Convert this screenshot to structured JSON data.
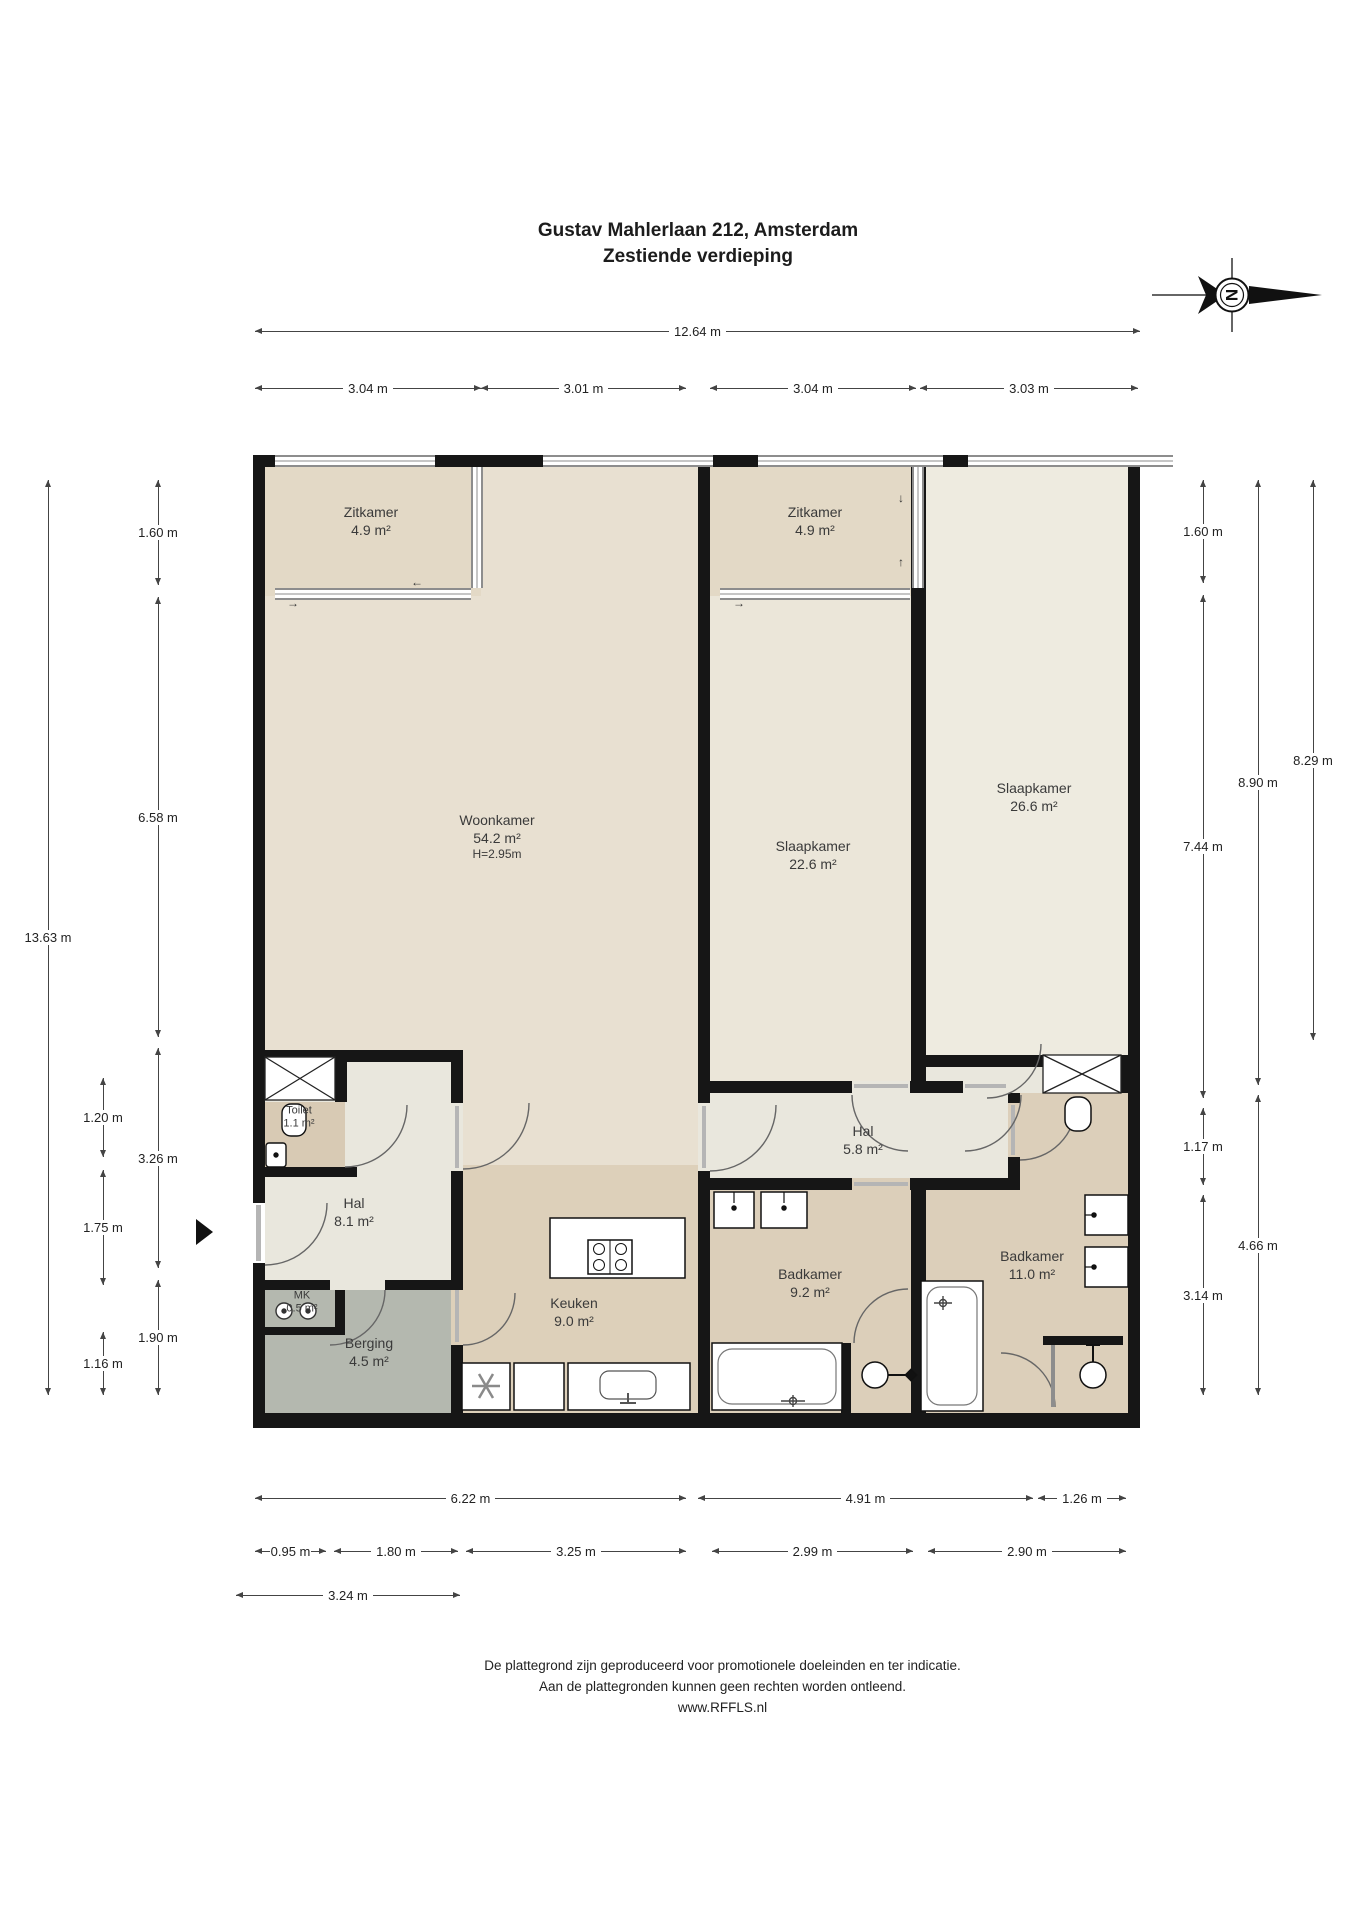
{
  "title": {
    "line1": "Gustav Mahlerlaan 212, Amsterdam",
    "line2": "Zestiende verdieping"
  },
  "compass": {
    "letter": "N"
  },
  "rooms": {
    "zitkamer_left": {
      "name": "Zitkamer",
      "area": "4.9 m²"
    },
    "zitkamer_right": {
      "name": "Zitkamer",
      "area": "4.9 m²"
    },
    "woonkamer": {
      "name": "Woonkamer",
      "area": "54.2 m²",
      "height": "H=2.95m"
    },
    "slaapkamer_1": {
      "name": "Slaapkamer",
      "area": "22.6 m²"
    },
    "slaapkamer_2": {
      "name": "Slaapkamer",
      "area": "26.6 m²"
    },
    "toilet": {
      "name": "Toilet",
      "area": "1.1 m²"
    },
    "hal": {
      "name": "Hal",
      "area": "8.1 m²"
    },
    "mk": {
      "name": "MK",
      "area": "0.5 m²"
    },
    "berging": {
      "name": "Berging",
      "area": "4.5 m²"
    },
    "keuken": {
      "name": "Keuken",
      "area": "9.0 m²"
    },
    "hal2": {
      "name": "Hal",
      "area": "5.8 m²"
    },
    "badkamer_1": {
      "name": "Badkamer",
      "area": "9.2 m²"
    },
    "badkamer_2": {
      "name": "Badkamer",
      "area": "11.0 m²"
    }
  },
  "dimensions": {
    "top_total": "12.64 m",
    "top_segments": [
      "3.04 m",
      "3.01 m",
      "3.04 m",
      "3.03 m"
    ],
    "left_outer": "13.63 m",
    "left_inner": [
      "1.60 m",
      "6.58 m",
      "3.26 m",
      "1.90 m"
    ],
    "left_inner2": [
      "1.20 m",
      "1.75 m",
      "1.16 m"
    ],
    "right_col1": [
      "1.60 m",
      "7.44 m",
      "1.17 m",
      "3.14 m"
    ],
    "right_col2": [
      "8.90 m",
      "4.66 m"
    ],
    "right_col3": [
      "8.29 m"
    ],
    "bottom_row1": [
      "6.22 m",
      "4.91 m",
      "1.26 m"
    ],
    "bottom_row2": [
      "0.95 m",
      "1.80 m",
      "3.25 m",
      "2.99 m",
      "2.90 m"
    ],
    "bottom_row3": [
      "3.24 m"
    ]
  },
  "arrows": {
    "right": "→",
    "left": "←",
    "up": "↑",
    "down": "↓"
  },
  "colors": {
    "wall": "#161616",
    "living": "#e8e0d1",
    "loggia": "#e3d9c6",
    "bedroom1": "#ebe6d9",
    "bedroom2": "#eeebe0",
    "wet": "#dccfba",
    "hall": "#e9e7dd",
    "storage": "#b4b8af"
  },
  "footer": {
    "line1": "De plattegrond zijn geproduceerd voor promotionele doeleinden en ter indicatie.",
    "line2": "Aan de plattegronden kunnen geen rechten worden ontleend.",
    "line3": "www.RFFLS.nl"
  }
}
